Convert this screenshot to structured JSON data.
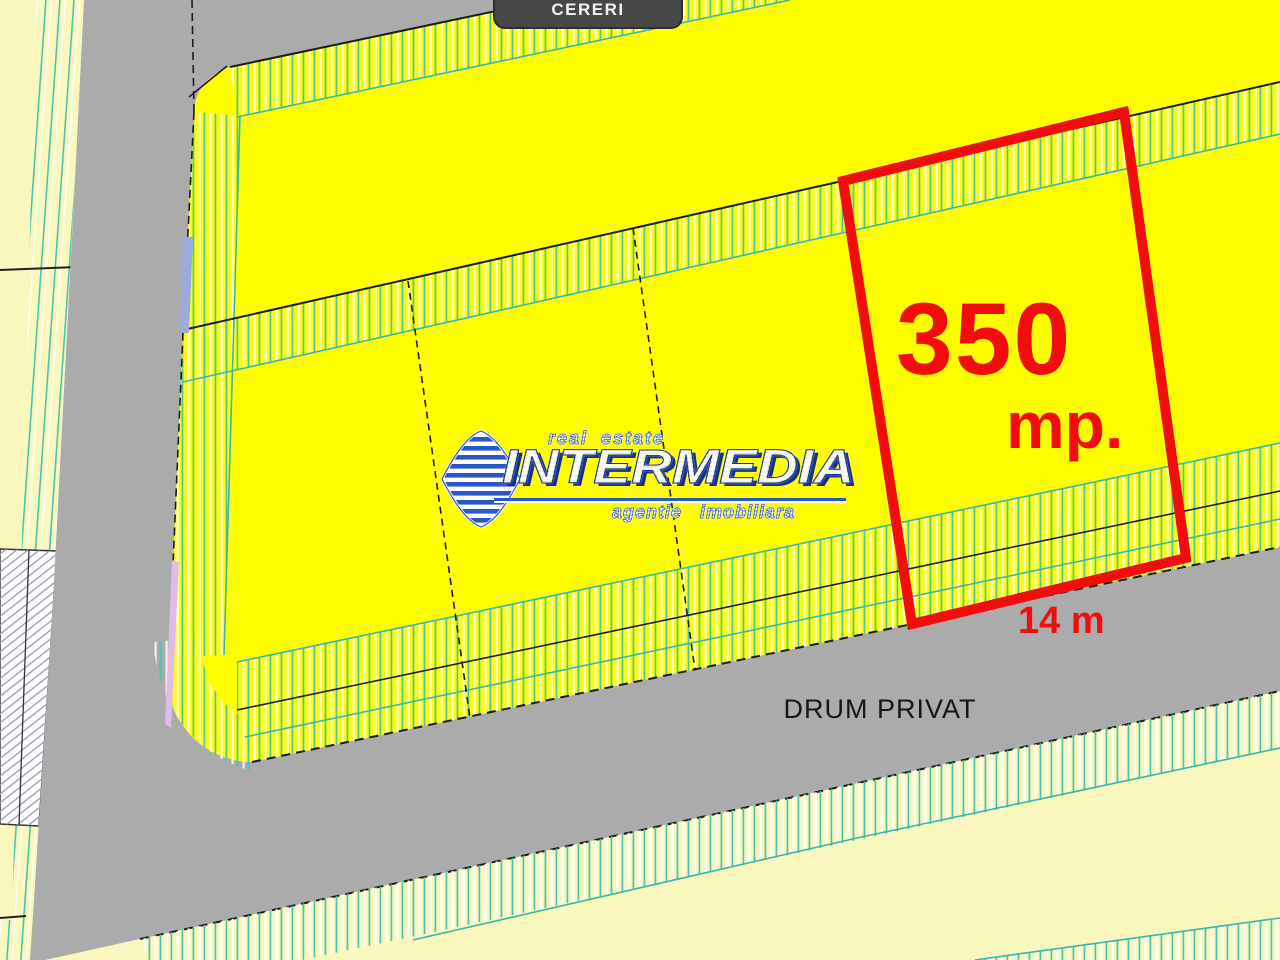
{
  "header": {
    "tab_label": "CERERI"
  },
  "highlighted_plot": {
    "area_value": "350",
    "area_unit": "mp.",
    "frontage": "14 m",
    "outline_color": "#F20D0D"
  },
  "road": {
    "label": "DRUM PRIVAT",
    "surface_color": "#ABABAB"
  },
  "logo": {
    "tagline_top": "real estate",
    "brand": "INTERMEDIA",
    "tagline_bottom": "agentie imobiliara"
  },
  "palette": {
    "parcel_yellow": "#FFFF00",
    "pale_yellow": "#FAF7BE",
    "hatch_teal": "#47C3B2",
    "road_gray": "#ABABAB",
    "tab_gray": "#474747",
    "highlight_red": "#F20D0D",
    "logo_blue": "#2A57C8",
    "logo_gold": "#FFD21C",
    "sliver_periwinkle": "#9BABDC",
    "sliver_lavender": "#DFBBE8"
  }
}
